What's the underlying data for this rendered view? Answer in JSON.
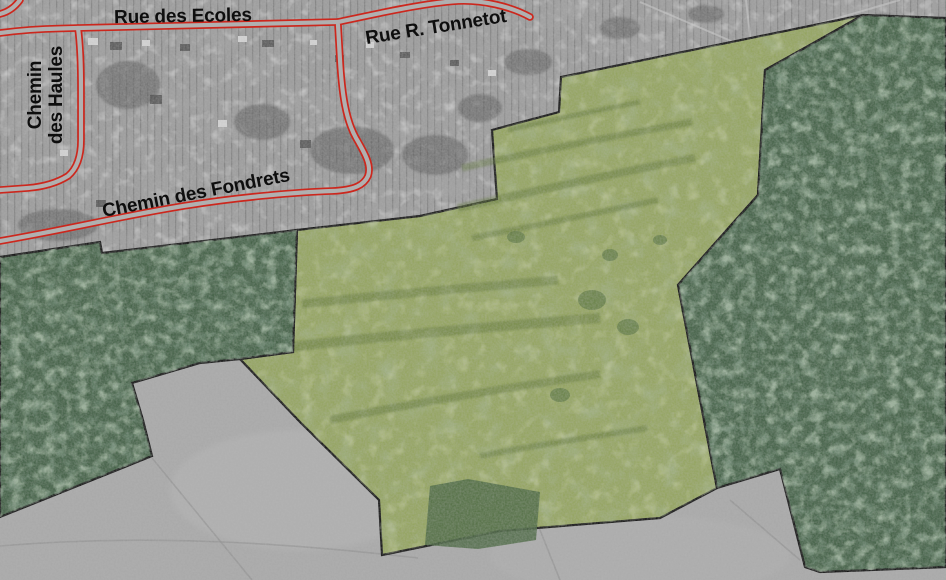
{
  "map": {
    "labels": {
      "ecoles": "Rue des Ecoles",
      "tonnetot": "Rue R. Tonnetot",
      "haules_line1": "Chemin",
      "haules_line2": "des Haules",
      "fondrets": "Chemin des Fondrets"
    },
    "colors": {
      "field": "#a9a9a9",
      "village": "#9c9c9c",
      "highlight": "#95a562",
      "forest": "#466349",
      "copse": "#4e6a45",
      "road": "#cc271d",
      "road_fill": "#b0b0b0",
      "border": "#161616",
      "label": "#0e0e0e"
    },
    "regions": {
      "village": {
        "points": "0,0 946,0 946,18 863,15 561,77 559,112 492,130 497,199 420,216 300,229 100,253 98,243 0,256"
      },
      "forest_west": {
        "points": "0,257 100,242 102,253 297,230 293,352 240,359 200,363 132,383 143,420 152,456 0,517"
      },
      "forest_east": {
        "points": "863,15 946,18 946,567 820,572 805,567 780,469 717,488 678,285 725,232 758,195 765,70 810,45"
      },
      "highlight_area": {
        "points": "492,130 559,112 561,77 863,15 810,45 765,70 758,195 725,232 678,285 717,488 660,518 500,531 382,555 379,500 300,422 240,359 293,352 297,230 420,216 497,199"
      },
      "copse": {
        "points": "425,545 430,486 468,479 540,492 536,540 478,549"
      }
    },
    "roads": {
      "ecoles": "M 0,33 Q 30,29 60,28.5 L 78,28 L 338,22",
      "corner": "M 0,14 Q 12,11 20,0",
      "haules": "M 78,28 Q 81,50 81,90 L 81,140 Q 81,165 68,176 Q 52,186 28,188 L 0,190",
      "tonnetot": "M 338,22 C 380,13 425,3 458,1 C 482,0 510,6 530,17",
      "fondrets": "M 0,241 C 70,229 130,214 190,205 C 240,197 300,192 332,191 C 355,190 364,185 368,176 C 372,165 364,152 356,138 C 346,120 342,95 340,60 L 338,25"
    }
  }
}
